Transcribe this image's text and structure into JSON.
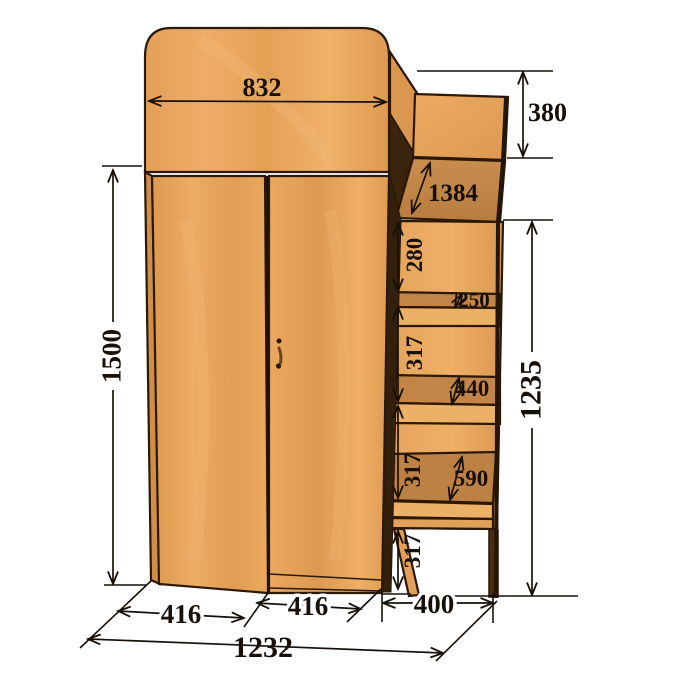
{
  "drawing": {
    "subject": "wardrobe-with-side-shelf-tower-dimension-drawing",
    "background": "#ffffff",
    "units_shown": "none (bare numbers, mm implied by convention)"
  },
  "colors": {
    "wood_light": "#e8a75e",
    "wood_mid": "#d9974f",
    "wood_top_surface": "#c28547",
    "wood_dark_edge": "#33200c",
    "outline": "#2b1806",
    "dimension_ink": "#171008"
  },
  "dimensions": {
    "top_panel_width": "832",
    "upper_box_height": "380",
    "worktop_panel_length": "1384",
    "gap_below_worktop": "280",
    "top_shelf_depth": "250",
    "gap_upper": "317",
    "middle_shelf_depth": "440",
    "gap_lower": "317",
    "bottom_shelf_depth": "590",
    "leg_height": "317",
    "wardrobe_height": "1500",
    "tower_height": "1235",
    "left_door_width": "416",
    "right_door_width": "416",
    "tower_depth": "400",
    "total_width": "1232"
  }
}
